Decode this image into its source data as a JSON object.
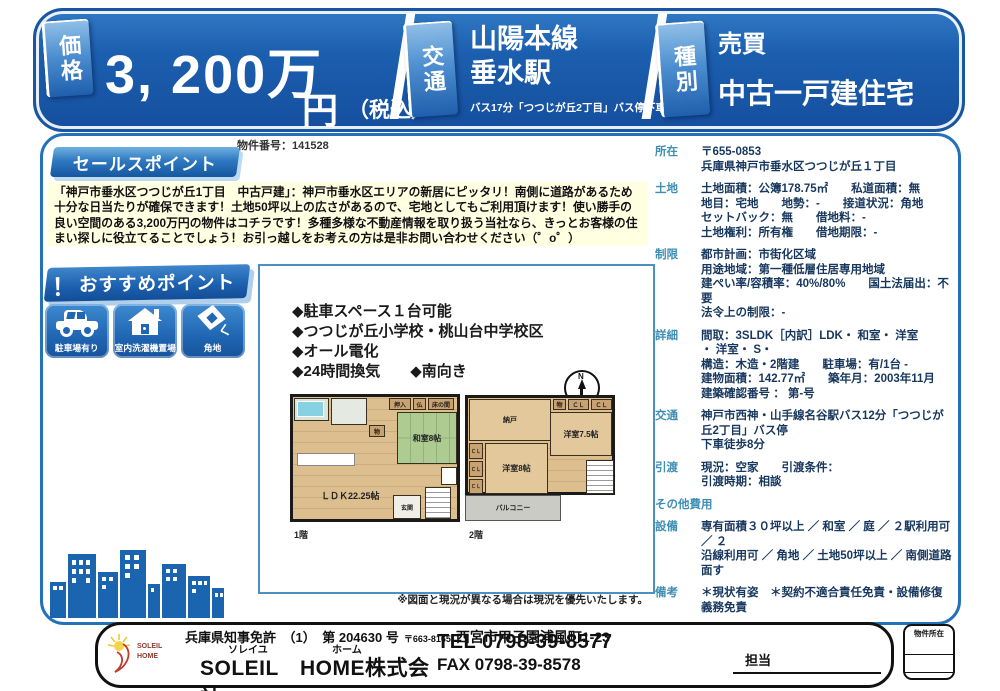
{
  "colors": {
    "banner_blue": "#1C5FAF",
    "tab_blue_light": "#8FBEE7",
    "label_teal": "#3E8EB4",
    "text_navy": "#17375E",
    "yellow_bg": "#FFFFE2",
    "wood": "#DDBE8F",
    "tatami_green": "#AECB92",
    "balcony_gray": "#CBCBC5",
    "skyline_blue": "#1B65B0"
  },
  "header": {
    "price_tab": "価格",
    "price_value": "3, 200万",
    "price_unit": "円",
    "price_tax": "（税込）",
    "transport_tab": "交通",
    "transport_line1": "山陽本線",
    "transport_line2": "垂水駅",
    "transport_note": "バス17分「つつじが丘2丁目」バス停下車徒歩8分",
    "type_tab": "種別",
    "type_line1": "売買",
    "type_line2": "中古一戸建住宅"
  },
  "property_number": "物件番号：141528",
  "sales_point": {
    "title": "セールスポイント",
    "body": "「神戸市垂水区つつじが丘1丁目　中古戸建」：神戸市垂水区エリアの新居にピッタリ！南側に道路があるため十分な日当たりが確保できます！土地50坪以上の広さがあるので、宅地としてもご利用頂けます！使い勝手の良い空間のある3,200万円の物件はコチラです！多種多様な不動産情報を取り扱う当社なら、きっとお客様の住まい探しに役立てることでしょう！お引っ越しをお考えの方は是非お問い合わせください（゜o゜）"
  },
  "recommend": {
    "bang": "！",
    "title": "おすすめポイント",
    "badges": [
      {
        "label": "駐車場有り"
      },
      {
        "label": "室内洗濯機置場"
      },
      {
        "label": "角地"
      }
    ]
  },
  "features": {
    "line1": "◆駐車スペース１台可能",
    "line2": "◆つつじが丘小学校・桃山台中学校区",
    "line3": "◆オール電化",
    "line4": "◆24時間換気　　◆南向き"
  },
  "floorplan": {
    "compass_n": "N",
    "f1": {
      "label": "1階",
      "oshiire": "押入",
      "butsudan": "仏",
      "tokonoma": "床の間",
      "mono": "物",
      "washitsu": "和室8帖",
      "ldk": "ＬＤＫ22.25帖",
      "genkan": "玄関"
    },
    "f2": {
      "label": "2階",
      "nando": "納戸",
      "mono": "物",
      "cl": "ＣＬ",
      "yoshitsu75": "洋室7.5帖",
      "yoshitsu8": "洋室8帖",
      "balcony": "バルコニー"
    },
    "note": "※図面と現況が異なる場合は現況を優先いたします。"
  },
  "details": {
    "rows": [
      {
        "label": "所在",
        "value": "〒655-0853\n兵庫県神戸市垂水区つつじが丘１丁目"
      },
      {
        "label": "土地",
        "value": "土地面積：公簿178.75㎡　　私道面積：無\n地目：宅地　　地勢：-　　接道状況：角地\nセットバック：無　　借地料：-\n土地権利：所有権　　借地期限：-"
      },
      {
        "label": "制限",
        "value": "都市計画：市街化区域\n用途地域：第一種低層住居専用地域\n建ぺい率/容積率：40%/80%　　国土法届出：不要\n法令上の制限：-"
      },
      {
        "label": "詳細",
        "value": "間取：3SLDK［内訳］LDK・ 和室・ 洋室\n・ 洋室・ S・\n構造：木造・2階建　　駐車場：有/1台 -\n建物面積：142.77㎡　　築年月：2003年11月\n建築確認番号 ： 第-号"
      },
      {
        "label": "交通",
        "value": "神戸市西神・山手線名谷駅バス12分「つつじが丘2丁目」バス停\n下車徒歩8分"
      },
      {
        "label": "引渡",
        "value": "現況：空家　　引渡条件：\n引渡時期：相談"
      },
      {
        "label": "その他費用",
        "value": ""
      },
      {
        "label": "設備",
        "value": "専有面積３０坪以上 ／ 和室 ／ 庭 ／ ２駅利用可 ／ ２\n沿線利用可 ／ 角地 ／ 土地50坪以上 ／ 南側道路面す"
      },
      {
        "label": "備考",
        "value": "＊現状有姿　＊契約不適合責任免責・設備修復義務免責"
      }
    ]
  },
  "footer": {
    "license": "兵庫県知事免許　（1）　第 204630 号",
    "postal": "〒663-8165",
    "address": "西宮市甲子園浦風町1-23",
    "furigana1": "ソレイユ",
    "furigana2": "ホーム",
    "company": "SOLEIL　HOME株式会社",
    "tel_label": "TEL ",
    "tel": "0798-39-8577",
    "fax_label": "FAX ",
    "fax": "0798-39-8578",
    "staff": "担当",
    "location_box": "物件所在"
  }
}
